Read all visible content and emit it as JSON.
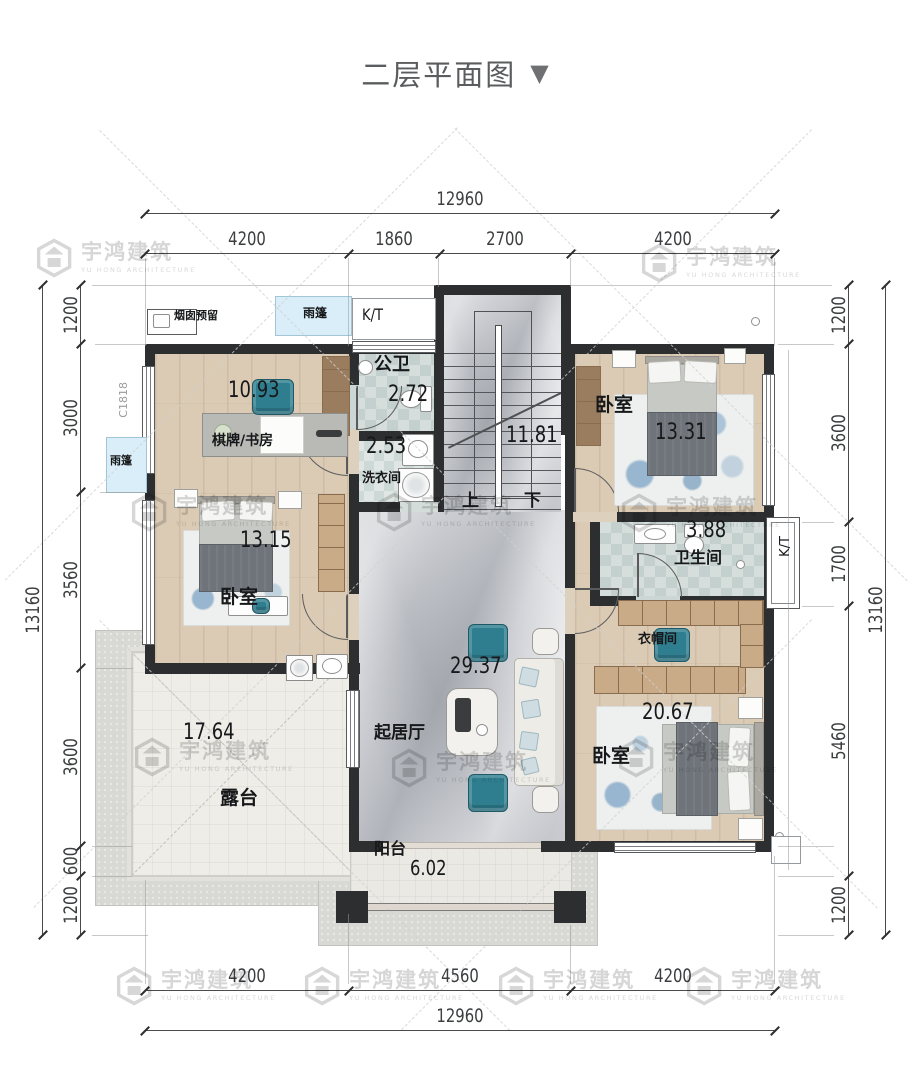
{
  "title": {
    "text": "二层平面图",
    "arrow": "▼"
  },
  "watermark": {
    "brand": "宇鸿建筑",
    "sub": "YU HONG ARCHITECTURE"
  },
  "dims": {
    "top_overall": [
      "12960"
    ],
    "top": [
      "4200",
      "1860",
      "2700",
      "4200"
    ],
    "bottom": [
      "4200",
      "4560",
      "4200"
    ],
    "bottom_overall": [
      "12960"
    ],
    "left_overall": [
      "13160"
    ],
    "left": [
      "1200",
      "3000",
      "3560",
      "3600",
      "600",
      "1200"
    ],
    "right": [
      "1200",
      "3600",
      "1700",
      "5460",
      "1200"
    ],
    "right_overall": [
      "13160"
    ]
  },
  "rooms": {
    "study": {
      "name": "棋牌/书房",
      "area": "10.93"
    },
    "guest_bath": {
      "name": "公卫",
      "area": "2.72"
    },
    "laundry": {
      "name": "洗衣间",
      "area": "2.53"
    },
    "stairwell": {
      "area": "11.81",
      "up": "上",
      "down": "下"
    },
    "bedroom_ne": {
      "name": "卧室",
      "area": "13.31"
    },
    "bedroom_w": {
      "name": "卧室",
      "area": "13.15"
    },
    "bathroom": {
      "name": "卫生间",
      "area": "3.88"
    },
    "cloakroom": {
      "name": "衣帽间"
    },
    "bedroom_se": {
      "name": "卧室",
      "area": "20.67"
    },
    "living": {
      "name": "起居厅",
      "area": "29.37"
    },
    "terrace": {
      "name": "露台",
      "area": "17.64"
    },
    "balcony": {
      "name": "阳台",
      "area": "6.02"
    }
  },
  "annotations": {
    "chimney": "烟囱预留",
    "canopy_top": "雨篷",
    "canopy_left": "雨篷",
    "kt_top": "K/T",
    "kt_right": "K/T",
    "window_code": "C1818"
  },
  "colors": {
    "wall": "#2d2e30",
    "wood": "#dbcbb5",
    "marble": "#caccd1",
    "teal": "#2f7e90",
    "canopy": "#d9eef8",
    "watermark": "#d6d6d6"
  }
}
